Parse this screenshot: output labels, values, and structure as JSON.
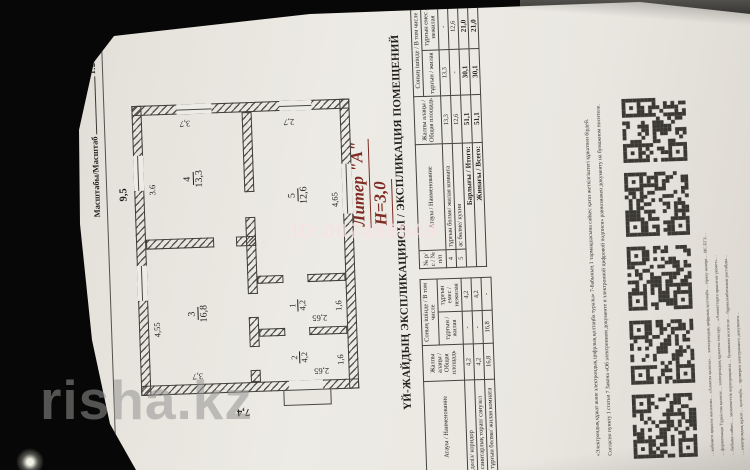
{
  "photo": {
    "watermark_site": "risha.kz",
    "watermark_id": "ID:007489949",
    "background_color": "#070707",
    "page_color": "#e9e6e0",
    "accent_red": "#7e2c24"
  },
  "header": {
    "title": "КУРЫЛЫС ЖОСПАРЫ / ПЛАН СТРОЕНИЯ",
    "liter_line": "Литерлер/Литеры: А",
    "floor_line": "1 кабат/этаж",
    "scale_label": "Масштабы/Масштаб",
    "scale_value": "1:200"
  },
  "plan": {
    "overall_width": "9,5",
    "overall_height": "7,4",
    "liter_note_line1": "Литер \"А\"",
    "liter_note_line2": "Н=3,0",
    "rooms": {
      "r3": {
        "num": "3",
        "area": "16,8",
        "dim_top": "4,55",
        "dim_side": "3,7"
      },
      "r4": {
        "num": "4",
        "area": "13,3",
        "dim_top": "3.6",
        "dim_side": "3,7"
      },
      "r5": {
        "num": "5",
        "area": "12,6",
        "dim_bottom": "4,65",
        "dim_side": "2,7"
      },
      "r2": {
        "num": "2",
        "area": "4,2",
        "dim_side": "2,65",
        "dim_bottom": "1,6"
      },
      "r1": {
        "num": "1",
        "area": "4,2",
        "dim_side": "2,65",
        "dim_bottom": "1,6"
      }
    }
  },
  "table": {
    "title": "ҮЙ-ЖАЙДЫҢ ЭКСПЛИКАЦИЯСЫ / ЭКСПЛИКАЦИЯ ПОМЕЩЕНИЙ",
    "col_num": "№ р/с / № п/п",
    "col_name": "Атауы / Наименование",
    "col_total": "Жалпы алаңы / Общая площадь",
    "col_incl": "Соның ішінде / В том числе",
    "col_living": "тұрғын / жилая",
    "col_nonliving": "тұрғын емес / нежилая",
    "rows_left": [
      {
        "num": "1",
        "name": "дәліз/ коридор",
        "total": "4,2",
        "living": "-",
        "nonliving": "4,2"
      },
      {
        "num": "2",
        "name": "санитарлық торап/ санузел",
        "total": "4,2",
        "living": "-",
        "nonliving": "4,2"
      },
      {
        "num": "3",
        "name": "тұрғын бөлме/ жилая комната",
        "total": "16,8",
        "living": "16,8",
        "nonliving": "-"
      }
    ],
    "rows_right": [
      {
        "num": "4",
        "name": "тұрғын бөлме/ жилая комната",
        "total": "13,3",
        "living": "13,3",
        "nonliving": "-"
      },
      {
        "num": "5",
        "name": "ас бөлме/ кухня",
        "total": "12,6",
        "living": "-",
        "nonliving": "12,6"
      }
    ],
    "totals": [
      {
        "label": "Барлығы / Итого:",
        "total": "51,1",
        "living": "30,1",
        "nonliving": "21,0"
      },
      {
        "label": "Жинағы / Всего:",
        "total": "51,1",
        "living": "30,1",
        "nonliving": "21,0"
      }
    ]
  },
  "footer": {
    "line_kk": "«Электрондық құжат және электрондық цифрлық қолтаңба туралы» 7-бабының 1 тармақшасына сәйкес қағаз жеткізгіштегі құжатпен бірдей.",
    "line_ru": "Согласно пункту 1 статьи 7 Закона «Об электронном документе и электронной цифровой подписи» равнозначен документу на бумажном носителе.",
    "qr_count": 5,
    "small_lines": [
      "…кабинеті арқылы жасалған… «Алматы қаласы»… электрондық цифрлық қолтаңба… тіркеу нөмірі… ИС ЕГЗ…",
      "…форматында Түркістан қаласы… электрондық құжатты тексеру… «Азаматтарға арналған үкімет»…",
      "…бабына сәйкес… мемлекеттік корпорациясы… бумажном носителе… бұрмаланбағанын растайды…",
      "…электрондық құжат… қолтаңба… проверки электронного документа…"
    ]
  }
}
